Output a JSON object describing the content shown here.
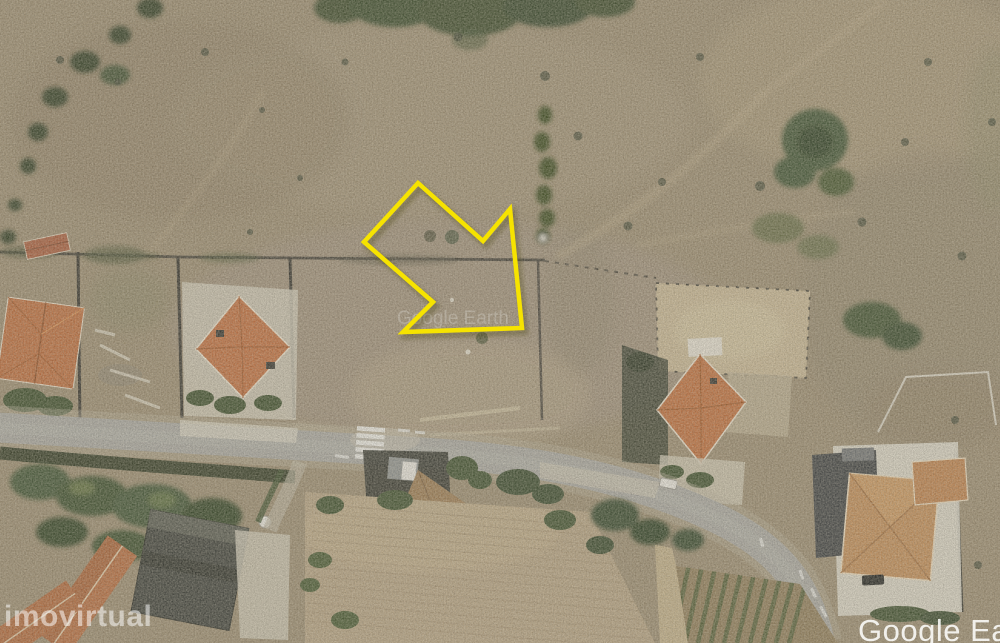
{
  "watermarks": {
    "portal_bottom_left": "imovirtual",
    "center_faint": "Google Earth",
    "provider_bottom_right": "Google Ea"
  },
  "annotation": {
    "arrow_points": "418,183 483,241 510,209 522,328 403,332 433,302 364,242",
    "arrow_color": "#F6E300"
  },
  "palette": {
    "scrubland": "#998a6f",
    "bare_soil": "#c6b593",
    "road_asphalt": "#a7a6a1",
    "roof_terracotta": "#c06c3c",
    "roof_tan": "#c08a54",
    "vegetation_dark": "#3a4c2b",
    "concrete": "#dedace",
    "crosswalk_white": "#eeeeea"
  }
}
